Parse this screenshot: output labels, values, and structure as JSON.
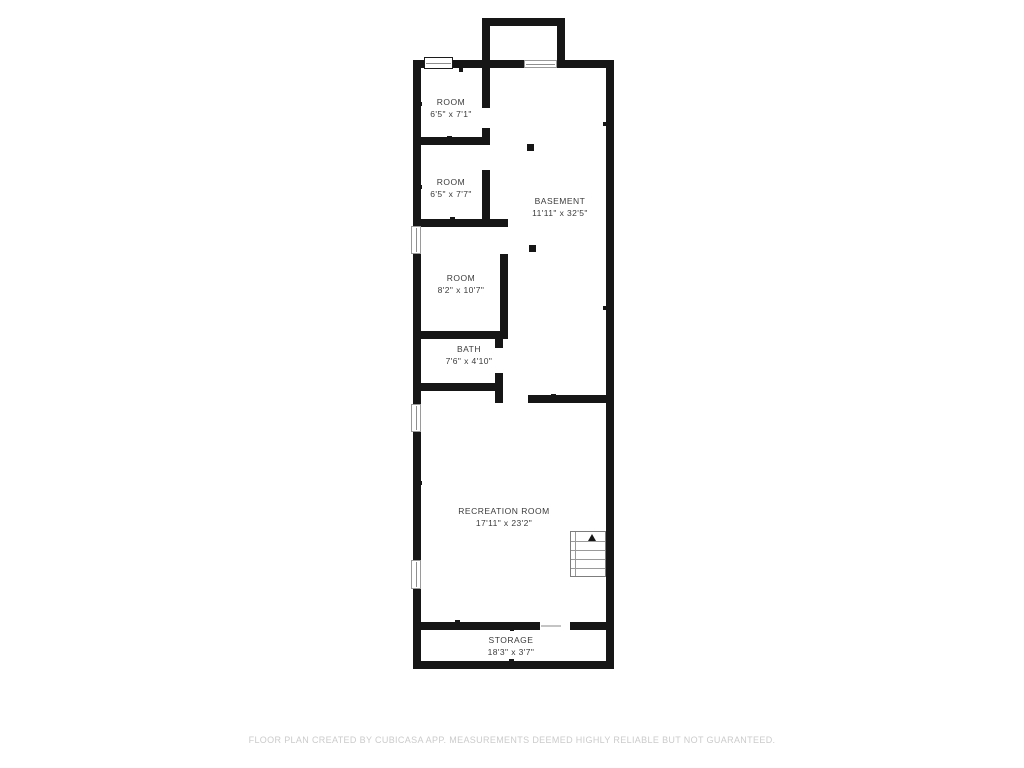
{
  "rooms": [
    {
      "id": "room-1",
      "name": "ROOM",
      "dims": "6'5\" x 7'1\""
    },
    {
      "id": "room-2",
      "name": "ROOM",
      "dims": "6'5\" x 7'7\""
    },
    {
      "id": "basement",
      "name": "BASEMENT",
      "dims": "11'11\" x 32'5\""
    },
    {
      "id": "room-3",
      "name": "ROOM",
      "dims": "8'2\" x 10'7\""
    },
    {
      "id": "bath",
      "name": "BATH",
      "dims": "7'6\" x 4'10\""
    },
    {
      "id": "recreation-room",
      "name": "RECREATION ROOM",
      "dims": "17'11\" x 23'2\""
    },
    {
      "id": "storage",
      "name": "STORAGE",
      "dims": "18'3\" x 3'7\""
    }
  ],
  "stairs": {
    "direction": "up"
  },
  "footer": "FLOOR PLAN CREATED BY CUBICASA APP. MEASUREMENTS DEEMED HIGHLY RELIABLE BUT NOT GUARANTEED.",
  "colors": {
    "wall": "#161616",
    "label": "#3b3b3b",
    "footer": "#cbcbcb",
    "window_border": "#9a9a9a"
  }
}
